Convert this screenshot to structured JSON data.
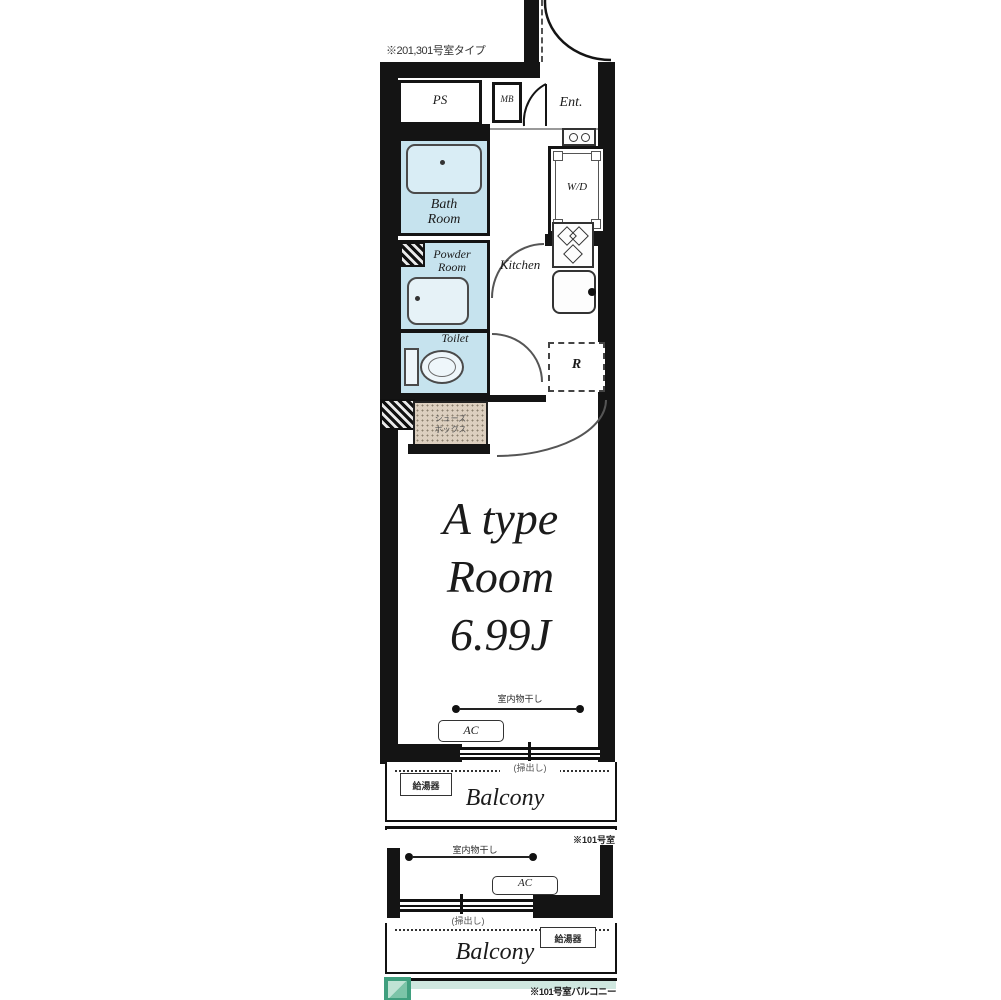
{
  "plan": {
    "top_note": "※201,301号室タイプ",
    "labels": {
      "ps": "PS",
      "mb": "MB",
      "ent": "Ent.",
      "bath_l1": "Bath",
      "bath_l2": "Room",
      "wd": "W/D",
      "powder_l1": "Powder",
      "powder_l2": "Room",
      "kitchen": "Kitchen",
      "toilet": "Toilet",
      "fridge": "R",
      "closet_l1": "シューズ",
      "closet_l2": "ボックス",
      "room_l1": "A type",
      "room_l2": "Room",
      "room_l3": "6.99J",
      "indoor_laundry": "室内物干し",
      "ac": "AC",
      "window_label": "(掃出し)",
      "balcony": "Balcony",
      "water_heater": "給湯器",
      "floor1_note": "※101号室",
      "footer_note": "※101号室バルコニー"
    },
    "colors": {
      "wet_room": "#c6e3ee",
      "closet": "#dccfbf",
      "wall": "#141414",
      "logo_green": "#3f9f7e",
      "teal_band": "#cfe7df"
    }
  }
}
